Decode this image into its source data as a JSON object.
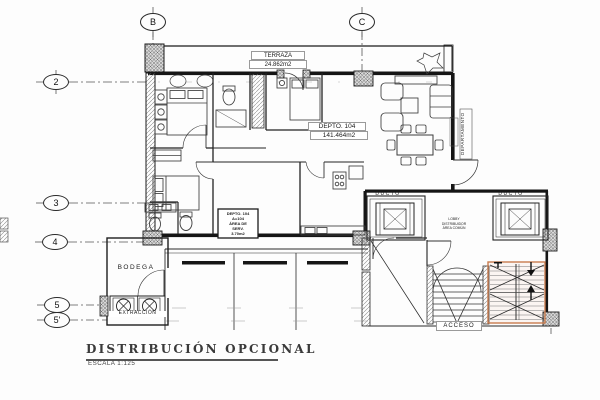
{
  "drawing": {
    "title": "DISTRIBUCIÓN OPCIONAL",
    "scale": "ESCALA 1:125"
  },
  "grid_columns": [
    {
      "label": "B"
    },
    {
      "label": "C"
    }
  ],
  "grid_rows": [
    {
      "label": "2"
    },
    {
      "label": "3"
    },
    {
      "label": "4"
    },
    {
      "label": "5"
    },
    {
      "label": "5'"
    }
  ],
  "labels": {
    "terraza": {
      "name": "TERRAZA",
      "area": "24.862m2"
    },
    "depto": {
      "name": "DEPTO. 104",
      "area": "141.464m2"
    },
    "servicio": {
      "line1": "DEPTO. 104",
      "line2": "A=104",
      "line3": "ÁREA DE",
      "line4": "SERV.",
      "line5": "3.70m2"
    },
    "ducto_left": "DUCTO",
    "ducto_right": "DUCTO",
    "lobby": {
      "line1": "LOBBY",
      "line2": "DISTRIBUIDOR",
      "line3": "ÁREA COMÚN"
    },
    "departamento": "DEPARTAMENTO",
    "bodega": "BODEGA",
    "extraccion": "EXTRACCIÓN",
    "acceso": "ACCESO"
  },
  "colors": {
    "line": "#1b1b1b",
    "stair_highlight": "#c97c4e"
  }
}
